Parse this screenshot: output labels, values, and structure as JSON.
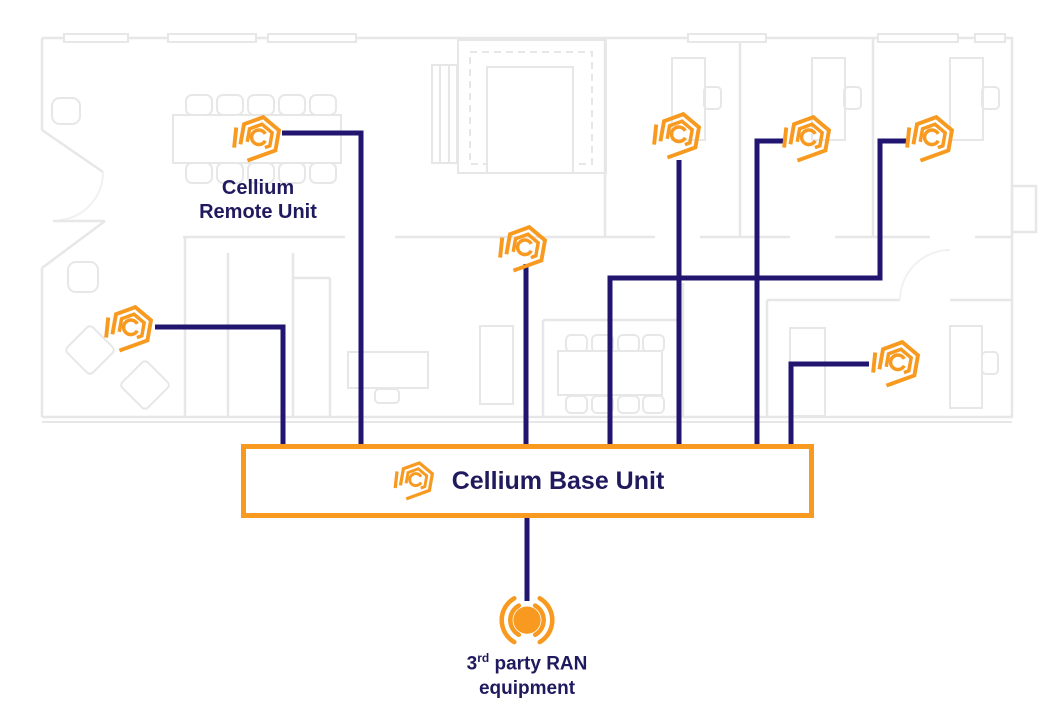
{
  "theme": {
    "orange": "#F79A1F",
    "navy_line": "#221570",
    "text_navy": "#1F1A5E",
    "floor_line": "#E7E7E7",
    "background": "#FFFFFF"
  },
  "labels": {
    "remote_unit_line1": "Cellium",
    "remote_unit_line2": "Remote Unit",
    "base_unit": "Cellium Base Unit",
    "ran_prefix": "3",
    "ran_sup": "rd",
    "ran_suffix": " party RAN",
    "ran_line2": "equipment"
  },
  "icons": {
    "remote_unit": "cellium-hexagon-logo",
    "base_unit": "cellium-hexagon-logo",
    "ran": "wireless-antenna"
  },
  "diagram": {
    "remote_unit_count": 7,
    "base_unit_count": 1
  }
}
